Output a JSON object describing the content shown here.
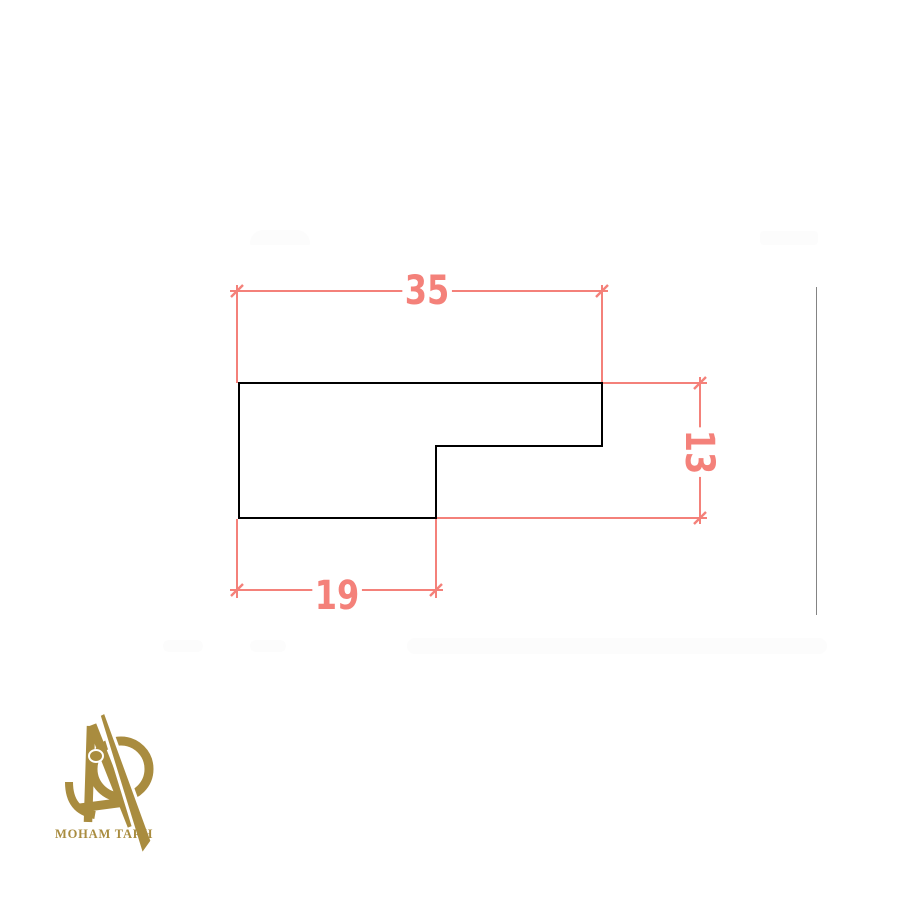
{
  "canvas": {
    "width": 900,
    "height": 900,
    "background": "#ffffff"
  },
  "colors": {
    "dimension": "#f4817a",
    "outline": "#000000",
    "logo_gold": "#a98c3f",
    "artifact_gray": "#6f6f6f",
    "smudge": "#fcfcfc"
  },
  "drawing": {
    "type": "cad-profile-drawing",
    "shape": "L-shaped step profile",
    "profile": {
      "top_width": 35,
      "right_height": 13,
      "bottom_step_width": 19
    },
    "dimensions": [
      {
        "id": "top-width",
        "label": "35",
        "orientation": "horizontal"
      },
      {
        "id": "right-height",
        "label": "13",
        "orientation": "vertical"
      },
      {
        "id": "bottom-width",
        "label": "19",
        "orientation": "horizontal"
      }
    ]
  },
  "logo": {
    "text": "MOHAM TARH"
  }
}
